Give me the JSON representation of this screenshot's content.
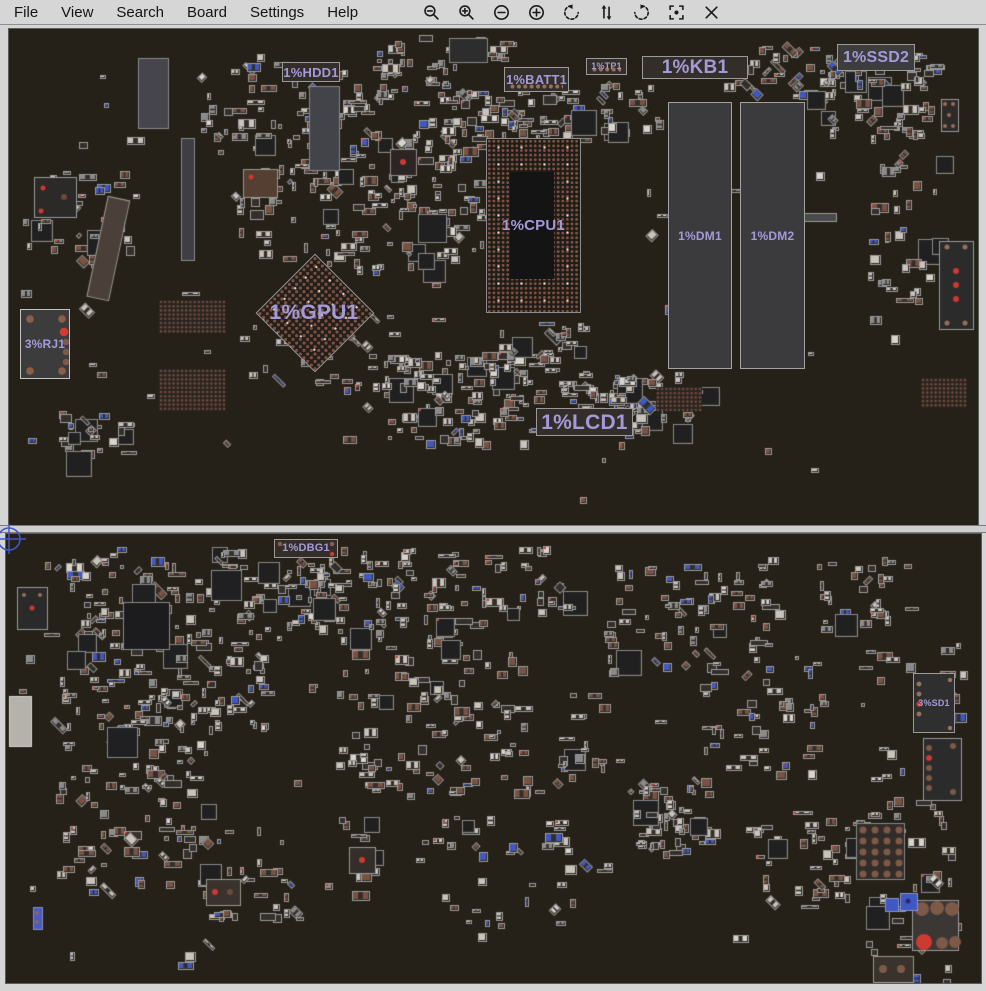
{
  "menubar": {
    "items": [
      "File",
      "View",
      "Search",
      "Board",
      "Settings",
      "Help"
    ],
    "icons": [
      "zoom-out-icon",
      "zoom-in-icon",
      "remove-circle-icon",
      "add-circle-icon",
      "rotate-ccw-icon",
      "flip-vertical-icon",
      "rotate-cw-icon",
      "center-focus-icon",
      "close-icon"
    ]
  },
  "theme": {
    "menubar_bg": "#d6d6d6",
    "board_bg": "#262118",
    "label_color": "#a59ad8",
    "accent_blue": "#3f58c4",
    "pad_brown": "#7a5242",
    "alert_red": "#cc3a30"
  },
  "boards": {
    "top": {
      "components": [
        {
          "id": "HDD1",
          "label": "1%HDD1",
          "type": "box",
          "x": 281,
          "y": 61,
          "w": 58,
          "h": 20,
          "fs": 13
        },
        {
          "id": "BATT1",
          "label": "1%BATT1",
          "type": "box",
          "x": 503,
          "y": 66,
          "w": 65,
          "h": 25,
          "fs": 13,
          "dots": true
        },
        {
          "id": "TP1",
          "label": "1%TP1",
          "type": "box",
          "x": 585,
          "y": 57,
          "w": 41,
          "h": 17,
          "fs": 9,
          "dots": true
        },
        {
          "id": "KB1",
          "label": "1%KB1",
          "type": "box",
          "x": 641,
          "y": 55,
          "w": 106,
          "h": 23,
          "fs": 19
        },
        {
          "id": "SSD2",
          "label": "1%SSD2",
          "type": "box",
          "x": 836,
          "y": 43,
          "w": 78,
          "h": 27,
          "fs": 16,
          "bg": "#3d3d3d"
        },
        {
          "id": "CPU1",
          "label": "1%CPU1",
          "type": "bga",
          "x": 485,
          "y": 137,
          "w": 95,
          "h": 175,
          "fs": 15,
          "center": [
            23,
            33,
            44,
            107
          ]
        },
        {
          "id": "DM1",
          "label": "1%DM1",
          "type": "dimm",
          "x": 667,
          "y": 101,
          "w": 64,
          "h": 267,
          "fs": 12
        },
        {
          "id": "DM2",
          "label": "1%DM2",
          "type": "dimm",
          "x": 739,
          "y": 101,
          "w": 65,
          "h": 267,
          "fs": 12
        },
        {
          "id": "GPU1",
          "label": "1%GPU1",
          "type": "bga-diamond",
          "x": 255,
          "y": 253,
          "w": 116,
          "h": 116,
          "fs": 21
        },
        {
          "id": "RJ1",
          "label": "3%RJ1",
          "type": "conn-rj",
          "x": 19,
          "y": 308,
          "w": 50,
          "h": 70,
          "fs": 12
        },
        {
          "id": "LCD1",
          "label": "1%LCD1",
          "type": "box",
          "x": 535,
          "y": 407,
          "w": 97,
          "h": 28,
          "fs": 21
        }
      ],
      "features": [
        {
          "x": 137,
          "y": 57,
          "w": 30,
          "h": 70,
          "fill": "#45454b",
          "stroke": "#8a8a8a"
        },
        {
          "x": 180,
          "y": 137,
          "w": 13,
          "h": 122,
          "fill": "#3e3e44",
          "stroke": "#8a8a8a"
        },
        {
          "x": 96,
          "y": 196,
          "w": 22,
          "h": 102,
          "fill": "#4a4039",
          "stroke": "#999999",
          "rot": 12
        },
        {
          "x": 308,
          "y": 85,
          "w": 30,
          "h": 84,
          "fill": "#43434a",
          "stroke": "#888888"
        },
        {
          "x": 33,
          "y": 176,
          "w": 42,
          "h": 40,
          "fill": "#2b2a28",
          "stroke": "#999999",
          "dots": [
            [
              9,
              11,
              2.5,
              "#cc3a30"
            ],
            [
              7,
              34,
              2.5,
              "#cc3a30"
            ],
            [
              30,
              20,
              3,
              "#6e4a3a"
            ]
          ]
        },
        {
          "x": 417,
          "y": 213,
          "w": 28,
          "h": 28,
          "fill": "#202020",
          "stroke": "#888888"
        },
        {
          "x": 389,
          "y": 148,
          "w": 26,
          "h": 26,
          "fill": "#2c2524",
          "stroke": "#998888",
          "dots": [
            [
              13,
              13,
              3,
              "#cc3a30"
            ]
          ]
        },
        {
          "x": 940,
          "y": 98,
          "w": 17,
          "h": 32,
          "fill": "#2d2a27",
          "stroke": "#999999",
          "dots": [
            [
              4,
              5,
              2,
              "#96705c"
            ],
            [
              12,
              5,
              2,
              "#96705c"
            ],
            [
              4,
              27,
              2,
              "#96705c"
            ],
            [
              12,
              27,
              2,
              "#96705c"
            ],
            [
              8,
              16,
              2,
              "#96705c"
            ]
          ]
        },
        {
          "x": 938,
          "y": 240,
          "w": 34,
          "h": 88,
          "fill": "#2b2b2b",
          "stroke": "#999999",
          "dots": [
            [
              8,
              6,
              2.5,
              "#96705c"
            ],
            [
              26,
              6,
              2.5,
              "#96705c"
            ],
            [
              8,
              82,
              2.5,
              "#96705c"
            ],
            [
              26,
              82,
              2.5,
              "#96705c"
            ],
            [
              17,
              30,
              3,
              "#cc3a30"
            ],
            [
              17,
              44,
              3,
              "#cc3a30"
            ],
            [
              17,
              58,
              3,
              "#cc3a30"
            ]
          ]
        },
        {
          "x": 797,
          "y": 212,
          "w": 38,
          "h": 8,
          "fill": "#4a4a4a",
          "stroke": "#999999"
        },
        {
          "x": 448,
          "y": 37,
          "w": 38,
          "h": 24,
          "fill": "#2d2d2d",
          "stroke": "#888888"
        },
        {
          "x": 242,
          "y": 168,
          "w": 34,
          "h": 28,
          "fill": "#553f33",
          "stroke": "#999988",
          "dots": [
            [
              8,
              8,
              2.5,
              "#cc3a30"
            ]
          ]
        }
      ],
      "pad_grids": [
        [
          158,
          299,
          66,
          33
        ],
        [
          158,
          368,
          66,
          42
        ],
        [
          655,
          386,
          46,
          24
        ],
        [
          920,
          377,
          46,
          30
        ]
      ],
      "clusters": [
        [
          195,
          58,
          280,
          77,
          90
        ],
        [
          235,
          130,
          245,
          135,
          160
        ],
        [
          230,
          310,
          180,
          85,
          30
        ],
        [
          380,
          350,
          165,
          90,
          110
        ],
        [
          440,
          80,
          135,
          60,
          50
        ],
        [
          555,
          370,
          105,
          62,
          55
        ],
        [
          820,
          50,
          115,
          85,
          70
        ],
        [
          865,
          150,
          70,
          190,
          35
        ],
        [
          25,
          165,
          100,
          100,
          40
        ],
        [
          55,
          410,
          80,
          40,
          25
        ],
        [
          20,
          35,
          940,
          475,
          70
        ],
        [
          580,
          370,
          120,
          55,
          30
        ],
        [
          480,
          318,
          100,
          42,
          25
        ],
        [
          585,
          80,
          75,
          50,
          25
        ],
        [
          745,
          45,
          95,
          55,
          35
        ],
        [
          370,
          33,
          140,
          27,
          25
        ],
        [
          495,
          90,
          80,
          50,
          20
        ]
      ]
    },
    "bottom": {
      "components": [
        {
          "id": "DBG1",
          "label": "1%DBG1",
          "type": "box",
          "x": 273,
          "y": 538,
          "w": 64,
          "h": 19,
          "fs": 11,
          "corners": true
        },
        {
          "id": "SD1",
          "label": "3%SD1",
          "type": "conn-sd",
          "x": 912,
          "y": 672,
          "w": 42,
          "h": 60,
          "fs": 9
        }
      ],
      "features": [
        {
          "x": 122,
          "y": 601,
          "w": 46,
          "h": 47,
          "fill": "#1c1c1e",
          "stroke": "#8a8a8a"
        },
        {
          "x": 210,
          "y": 569,
          "w": 30,
          "h": 30,
          "fill": "#202022",
          "stroke": "#888888"
        },
        {
          "x": 106,
          "y": 726,
          "w": 30,
          "h": 30,
          "fill": "#202022",
          "stroke": "#888888"
        },
        {
          "x": 8,
          "y": 695,
          "w": 22,
          "h": 50,
          "fill": "#b5b1ab",
          "stroke": "#d8d8d8"
        },
        {
          "x": 16,
          "y": 586,
          "w": 30,
          "h": 42,
          "fill": "#2a2a2a",
          "stroke": "#999999",
          "dots": [
            [
              15,
              21,
              2.5,
              "#cc3a30"
            ],
            [
              7,
              8,
              2,
              "#96705c"
            ],
            [
              23,
              8,
              2,
              "#96705c"
            ]
          ]
        },
        {
          "x": 922,
          "y": 737,
          "w": 38,
          "h": 62,
          "fill": "#2b2b2b",
          "stroke": "#999999",
          "dots": [
            [
              6,
              10,
              3,
              "#7d5948"
            ],
            [
              6,
              20,
              3,
              "#cc3a30"
            ],
            [
              6,
              30,
              3,
              "#7d5948"
            ],
            [
              6,
              40,
              3,
              "#7d5948"
            ],
            [
              6,
              50,
              3,
              "#7d5948"
            ],
            [
              30,
              8,
              3,
              "#7d5948"
            ],
            [
              30,
              54,
              3,
              "#7d5948"
            ]
          ]
        },
        {
          "x": 855,
          "y": 822,
          "w": 48,
          "h": 56,
          "fill": "#322d29",
          "stroke": "#888888",
          "grid": {
            "cols": 4,
            "rows": 5,
            "pitch": [
              12,
              11
            ],
            "off": [
              7,
              7
            ],
            "r": 3.5,
            "c": "#7d5948"
          }
        },
        {
          "x": 911,
          "y": 899,
          "w": 46,
          "h": 50,
          "fill": "#3a3734",
          "stroke": "#999999",
          "dots": [
            [
              10,
              9,
              7,
              "#7d5948"
            ],
            [
              25,
              8,
              7,
              "#7d5948"
            ],
            [
              40,
              9,
              7,
              "#7d5948"
            ],
            [
              12,
              42,
              8,
              "#cc3a30"
            ],
            [
              30,
              43,
              6,
              "#7d5948"
            ],
            [
              43,
              42,
              6,
              "#7d5948"
            ]
          ]
        },
        {
          "x": 884,
          "y": 897,
          "w": 13,
          "h": 13,
          "fill": "#3f58c4",
          "stroke": "#8a94c0"
        },
        {
          "x": 899,
          "y": 892,
          "w": 17,
          "h": 17,
          "fill": "#3f58c4",
          "stroke": "#8a94c0",
          "dots": [
            [
              8,
              8,
              2.5,
              "#2a2a66"
            ]
          ]
        },
        {
          "x": 32,
          "y": 906,
          "w": 9,
          "h": 22,
          "fill": "#4a5ac8",
          "stroke": "#8890b0",
          "dots": [
            [
              4,
              6,
              2,
              "#8a6a5a"
            ],
            [
              4,
              15,
              2,
              "#8a6a5a"
            ]
          ]
        },
        {
          "x": 205,
          "y": 878,
          "w": 34,
          "h": 26,
          "fill": "#39322d",
          "stroke": "#999988",
          "dots": [
            [
              9,
              13,
              3,
              "#cc3a30"
            ],
            [
              24,
              13,
              3,
              "#6e4a3a"
            ]
          ]
        },
        {
          "x": 348,
          "y": 846,
          "w": 26,
          "h": 26,
          "fill": "#332e2a",
          "stroke": "#999999",
          "dots": [
            [
              13,
              13,
              3,
              "#cc3a30"
            ]
          ]
        },
        {
          "x": 872,
          "y": 955,
          "w": 40,
          "h": 26,
          "fill": "#39322d",
          "stroke": "#999988",
          "dots": [
            [
              10,
              13,
              4,
              "#7d5948"
            ],
            [
              28,
              13,
              4,
              "#7d5948"
            ]
          ]
        }
      ],
      "pad_grids": [],
      "clusters": [
        [
          55,
          545,
          210,
          180,
          200
        ],
        [
          55,
          720,
          150,
          170,
          90
        ],
        [
          275,
          545,
          155,
          80,
          70
        ],
        [
          330,
          615,
          195,
          175,
          110
        ],
        [
          425,
          545,
          140,
          70,
          40
        ],
        [
          600,
          555,
          170,
          115,
          70
        ],
        [
          630,
          775,
          75,
          75,
          60
        ],
        [
          690,
          650,
          130,
          120,
          40
        ],
        [
          745,
          810,
          125,
          95,
          40
        ],
        [
          815,
          555,
          90,
          70,
          30
        ],
        [
          860,
          635,
          100,
          345,
          60
        ],
        [
          195,
          815,
          175,
          100,
          35
        ],
        [
          415,
          810,
          150,
          115,
          35
        ],
        [
          15,
          540,
          945,
          430,
          80
        ],
        [
          555,
          690,
          45,
          100,
          20
        ],
        [
          275,
          560,
          65,
          40,
          15
        ]
      ]
    }
  }
}
